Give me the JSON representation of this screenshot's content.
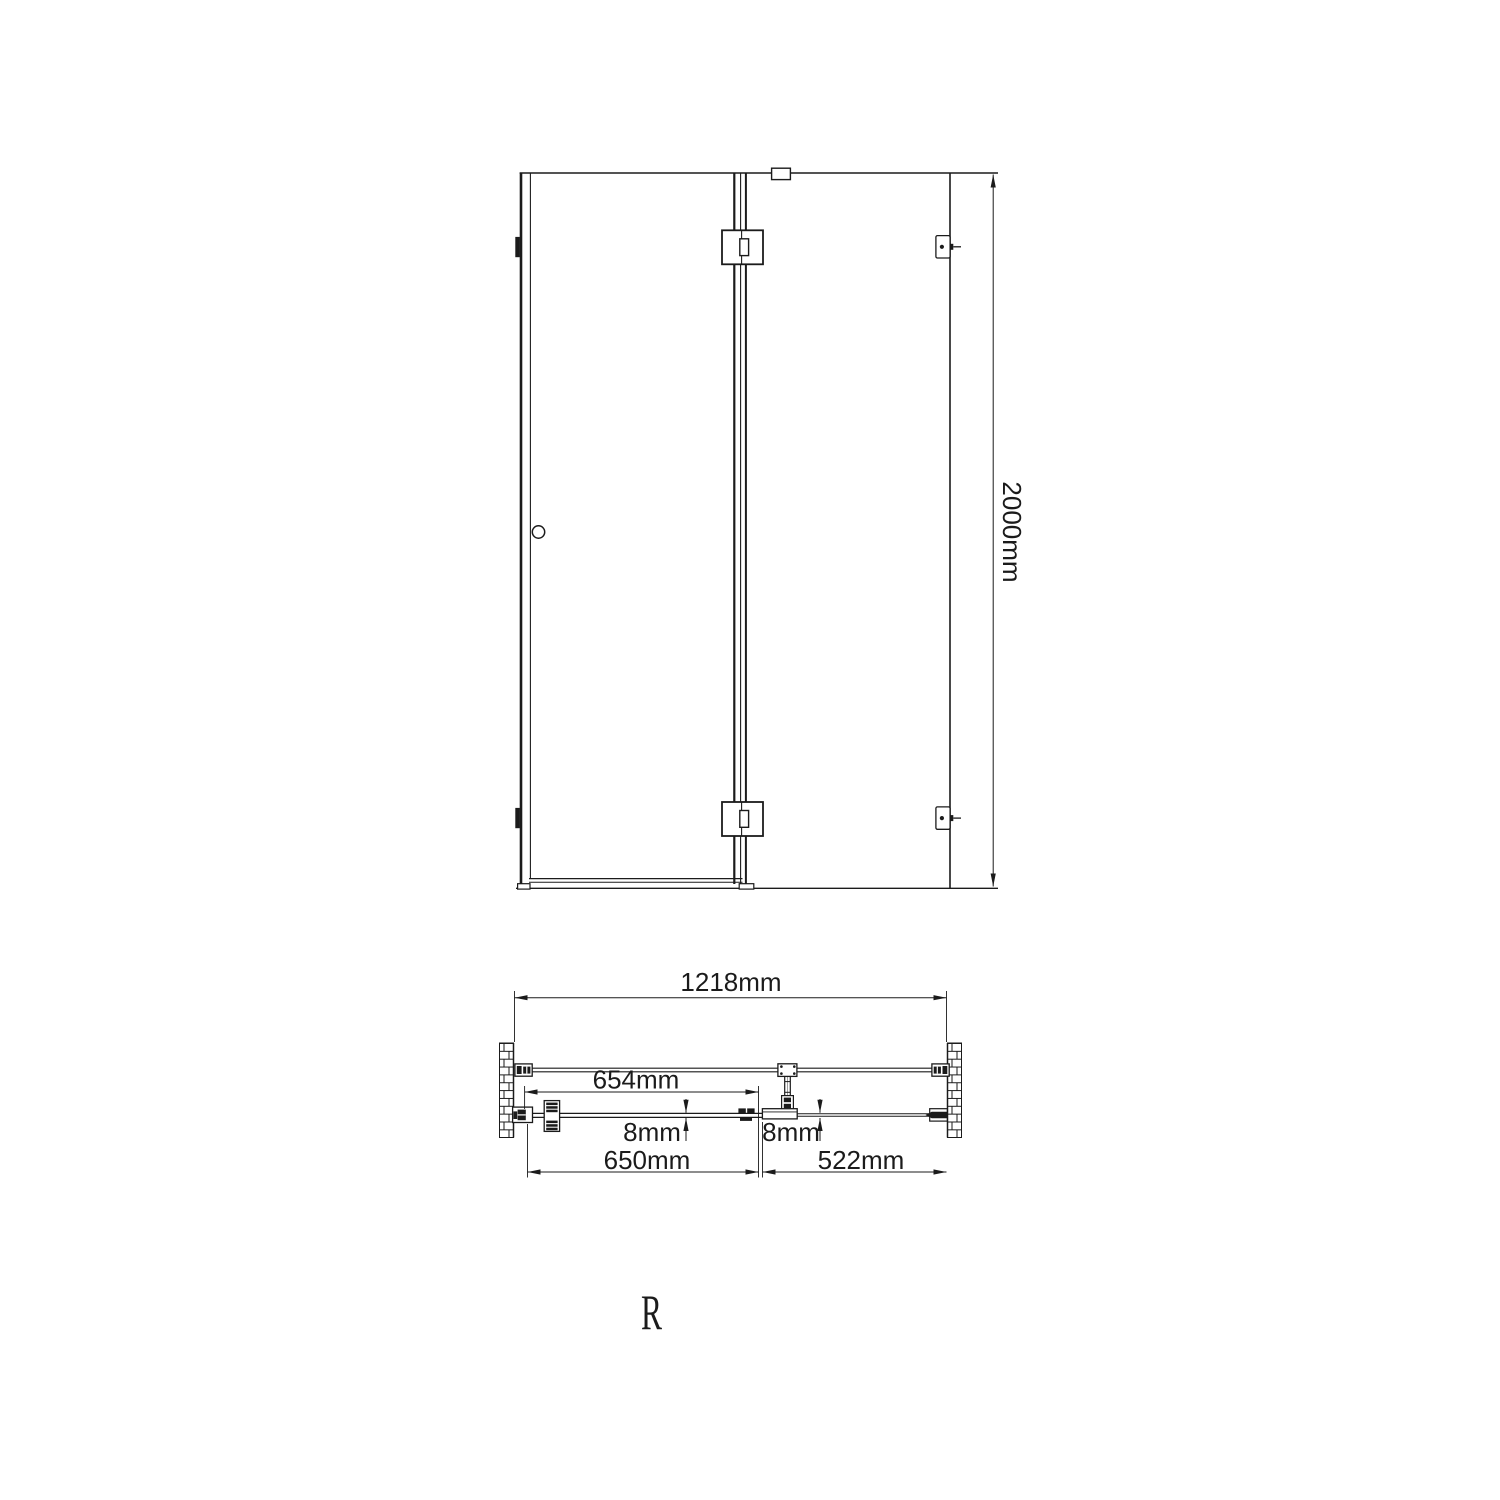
{
  "page": {
    "background": "#ffffff",
    "ink": "#1b1b1b"
  },
  "front_view": {
    "height_dim_label": "2000mm"
  },
  "plan_view": {
    "overall_width_label": "1218mm",
    "door_glass_width_label": "654mm",
    "door_glass_thickness_label": "8mm",
    "panel_glass_thickness_label": "8mm",
    "door_width_label": "650mm",
    "side_panel_width_label": "522mm"
  },
  "footer": {
    "orientation_label": "R"
  }
}
